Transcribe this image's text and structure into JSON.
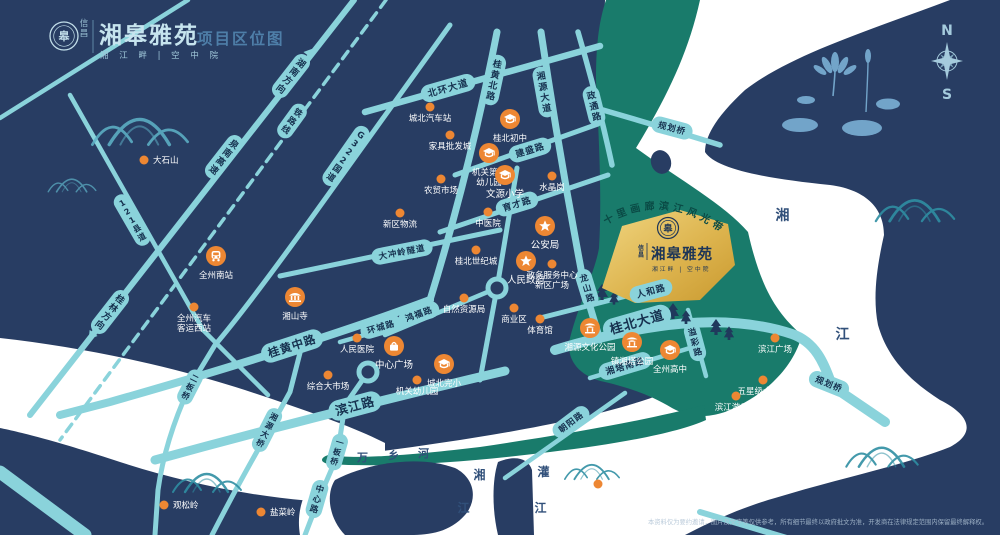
{
  "header": {
    "brand_small": "信昌",
    "title": "湘皋雅苑",
    "page_label": "项目区位图",
    "subtitle": "湘 江 畔 | 空 中 院",
    "logo_glyph": "皋"
  },
  "compass": {
    "north": "N",
    "south": "S"
  },
  "project": {
    "brand_small": "信昌",
    "name": "湘皋雅苑",
    "subtitle": "湘江畔 | 空中院",
    "logo_glyph": "皋"
  },
  "map": {
    "banner": "十里画廊滨江风光带",
    "colors": {
      "bg": "#283D63",
      "road": "#8AD3DB",
      "green": "#197B6B",
      "river": "#FFFFFF",
      "orange": "#ED8733",
      "gold_light": "#F0D580",
      "gold_dark": "#C9992F",
      "capsule_text": "#16314F"
    },
    "road_labels": [
      {
        "t": "桂黄北路",
        "x": 494,
        "y": 80,
        "r": 12,
        "k": "v",
        "fs": 9
      },
      {
        "t": "湘源大道",
        "x": 544,
        "y": 92,
        "r": -10,
        "k": "v",
        "fs": 9
      },
      {
        "t": "政通路",
        "x": 594,
        "y": 106,
        "r": -14,
        "k": "v",
        "fs": 9
      },
      {
        "t": "北环大道",
        "x": 448,
        "y": 88,
        "r": -16,
        "k": "h",
        "fs": 9.5
      },
      {
        "t": "建盛路",
        "x": 530,
        "y": 150,
        "r": -17,
        "k": "h",
        "fs": 9
      },
      {
        "t": "育才路",
        "x": 517,
        "y": 204,
        "r": -17,
        "k": "h",
        "fs": 9
      },
      {
        "t": "大冲岭隧道",
        "x": 402,
        "y": 252,
        "r": -11,
        "k": "h",
        "fs": 8.5
      },
      {
        "t": "人和路",
        "x": 651,
        "y": 291,
        "r": -15,
        "k": "h",
        "fs": 9
      },
      {
        "t": "桂北大道",
        "x": 637,
        "y": 322,
        "r": -16,
        "k": "h",
        "fs": 13
      },
      {
        "t": "湘塔南路",
        "x": 625,
        "y": 366,
        "r": -17,
        "k": "h",
        "fs": 9
      },
      {
        "t": "溢彩路",
        "x": 695,
        "y": 342,
        "r": -15,
        "k": "v",
        "fs": 8.5
      },
      {
        "t": "龙山路",
        "x": 587,
        "y": 288,
        "r": -17,
        "k": "v",
        "fs": 8.5
      },
      {
        "t": "滨江路",
        "x": 355,
        "y": 406,
        "r": -15,
        "k": "h",
        "fs": 12.5
      },
      {
        "t": "桂黄中路",
        "x": 292,
        "y": 346,
        "r": -18,
        "k": "h",
        "fs": 11.5
      },
      {
        "t": "环城路",
        "x": 381,
        "y": 327,
        "r": -16,
        "k": "h",
        "fs": 8.5
      },
      {
        "t": "鸿福路",
        "x": 419,
        "y": 314,
        "r": -20,
        "k": "h",
        "fs": 8.5
      },
      {
        "t": "朝阳路",
        "x": 571,
        "y": 422,
        "r": -37,
        "k": "h",
        "fs": 8.5
      },
      {
        "t": "中心路",
        "x": 317,
        "y": 499,
        "r": 16,
        "k": "v",
        "fs": 8.5
      },
      {
        "t": "一板桥",
        "x": 337,
        "y": 452,
        "r": 16,
        "k": "v",
        "fs": 8
      },
      {
        "t": "湘源大桥",
        "x": 267,
        "y": 430,
        "r": 27,
        "k": "v",
        "fs": 8
      },
      {
        "t": "二板桥",
        "x": 190,
        "y": 387,
        "r": 27,
        "k": "v",
        "fs": 8
      },
      {
        "t": "G322国道",
        "x": 346,
        "y": 156,
        "r": 35,
        "k": "v",
        "fs": 8.5
      },
      {
        "t": "铁路线",
        "x": 292,
        "y": 121,
        "r": 36,
        "k": "v",
        "fs": 8.5
      },
      {
        "t": "121县道",
        "x": 132,
        "y": 220,
        "r": -30,
        "k": "v",
        "fs": 8
      },
      {
        "t": "泉南高速",
        "x": 224,
        "y": 157,
        "r": 38,
        "k": "v",
        "fs": 9
      },
      {
        "t": "湖南方向",
        "x": 291,
        "y": 76,
        "r": 38,
        "k": "v",
        "fs": 9,
        "arrow": "up"
      },
      {
        "t": "桂林方向",
        "x": 110,
        "y": 312,
        "r": 38,
        "k": "v",
        "fs": 9,
        "arrow": "down"
      },
      {
        "t": "规划桥",
        "x": 672,
        "y": 128,
        "r": 15,
        "k": "h",
        "fs": 8.5
      },
      {
        "t": "规划桥",
        "x": 829,
        "y": 384,
        "r": 22,
        "k": "h",
        "fs": 8.5
      }
    ],
    "pois": [
      {
        "t": "大石山",
        "x": 144,
        "y": 160,
        "type": "dot",
        "lp": "r"
      },
      {
        "t": "城北汽车站",
        "x": 430,
        "y": 107,
        "type": "dot",
        "lp": "b"
      },
      {
        "t": "家具批发城",
        "x": 450,
        "y": 135,
        "type": "dot",
        "lp": "b"
      },
      {
        "t": "农贸市场",
        "x": 441,
        "y": 179,
        "type": "dot",
        "lp": "b"
      },
      {
        "t": "水晶岗",
        "x": 552,
        "y": 176,
        "type": "dot",
        "lp": "b"
      },
      {
        "t": "新区物流",
        "x": 400,
        "y": 213,
        "type": "dot",
        "lp": "b"
      },
      {
        "t": "中医院",
        "x": 488,
        "y": 212,
        "type": "dot",
        "lp": "b"
      },
      {
        "t": "桂北世纪城",
        "x": 476,
        "y": 250,
        "type": "dot",
        "lp": "b"
      },
      {
        "t": "政务服务中心\n新区广场",
        "x": 552,
        "y": 264,
        "type": "dot",
        "lp": "b"
      },
      {
        "t": "自然资源局",
        "x": 464,
        "y": 298,
        "type": "dot",
        "lp": "b"
      },
      {
        "t": "商业区",
        "x": 514,
        "y": 308,
        "type": "dot",
        "lp": "b"
      },
      {
        "t": "体育馆",
        "x": 540,
        "y": 319,
        "type": "dot",
        "lp": "b"
      },
      {
        "t": "人民医院",
        "x": 357,
        "y": 338,
        "type": "dot",
        "lp": "b"
      },
      {
        "t": "综合大市场",
        "x": 328,
        "y": 375,
        "type": "dot",
        "lp": "b"
      },
      {
        "t": "机关幼儿园",
        "x": 417,
        "y": 380,
        "type": "dot",
        "lp": "b"
      },
      {
        "t": "全州汽车\n客运西站",
        "x": 194,
        "y": 307,
        "type": "dot",
        "lp": "b"
      },
      {
        "t": "滨江广场",
        "x": 775,
        "y": 338,
        "type": "dot",
        "lp": "b"
      },
      {
        "t": "五星级大酒店",
        "x": 763,
        "y": 380,
        "type": "dot",
        "lp": "b"
      },
      {
        "t": "滨江游乐园",
        "x": 736,
        "y": 396,
        "type": "dot",
        "lp": "b"
      },
      {
        "t": "雷公岭国家\n矿山公园",
        "x": 598,
        "y": 484,
        "type": "dot",
        "lp": "b"
      },
      {
        "t": "观松岭",
        "x": 164,
        "y": 505,
        "type": "dot",
        "lp": "r"
      },
      {
        "t": "盐菜岭",
        "x": 261,
        "y": 512,
        "type": "dot",
        "lp": "r"
      },
      {
        "t": "桂北初中",
        "x": 510,
        "y": 119,
        "type": "school",
        "lp": "b"
      },
      {
        "t": "机关第二\n幼儿园",
        "x": 489,
        "y": 153,
        "type": "school",
        "lp": "b"
      },
      {
        "t": "文源小学",
        "x": 505,
        "y": 175,
        "type": "school",
        "lp": "b",
        "fs": 9.5
      },
      {
        "t": "城北完小",
        "x": 444,
        "y": 364,
        "type": "school",
        "lp": "b"
      },
      {
        "t": "全州高中",
        "x": 670,
        "y": 350,
        "type": "school",
        "lp": "b"
      },
      {
        "t": "公安局",
        "x": 545,
        "y": 226,
        "type": "star",
        "lp": "b",
        "fs": 9.5
      },
      {
        "t": "人民政府",
        "x": 526,
        "y": 261,
        "type": "star",
        "lp": "b",
        "fs": 9.5
      },
      {
        "t": "湘山寺",
        "x": 295,
        "y": 297,
        "type": "temple",
        "lp": "b"
      },
      {
        "t": "中心广场",
        "x": 394,
        "y": 346,
        "type": "plaza",
        "lp": "b",
        "fs": 9.5
      },
      {
        "t": "全州南站",
        "x": 216,
        "y": 256,
        "type": "train",
        "lp": "b"
      },
      {
        "t": "湘源文化公园",
        "x": 590,
        "y": 328,
        "type": "park",
        "lp": "b"
      },
      {
        "t": "镇湘塔公园",
        "x": 632,
        "y": 342,
        "type": "park",
        "lp": "b"
      }
    ],
    "river_labels": [
      {
        "t": "万",
        "x": 363,
        "y": 461,
        "fs": 11
      },
      {
        "t": "乡",
        "x": 394,
        "y": 459,
        "fs": 11
      },
      {
        "t": "河",
        "x": 424,
        "y": 457,
        "fs": 11
      },
      {
        "t": "湘",
        "x": 480,
        "y": 479,
        "fs": 12
      },
      {
        "t": "江",
        "x": 464,
        "y": 512,
        "fs": 12
      },
      {
        "t": "灌",
        "x": 544,
        "y": 476,
        "fs": 12
      },
      {
        "t": "江",
        "x": 541,
        "y": 512,
        "fs": 12
      },
      {
        "t": "湘",
        "x": 783,
        "y": 220,
        "fs": 14
      },
      {
        "t": "江",
        "x": 843,
        "y": 339,
        "fs": 14
      }
    ]
  },
  "disclaimer": "本资料仅为要约邀请，图片及文字等仅供参考，所有细节最终以政府批文为准，开发商在法律规定范围内保留最终解释权。"
}
